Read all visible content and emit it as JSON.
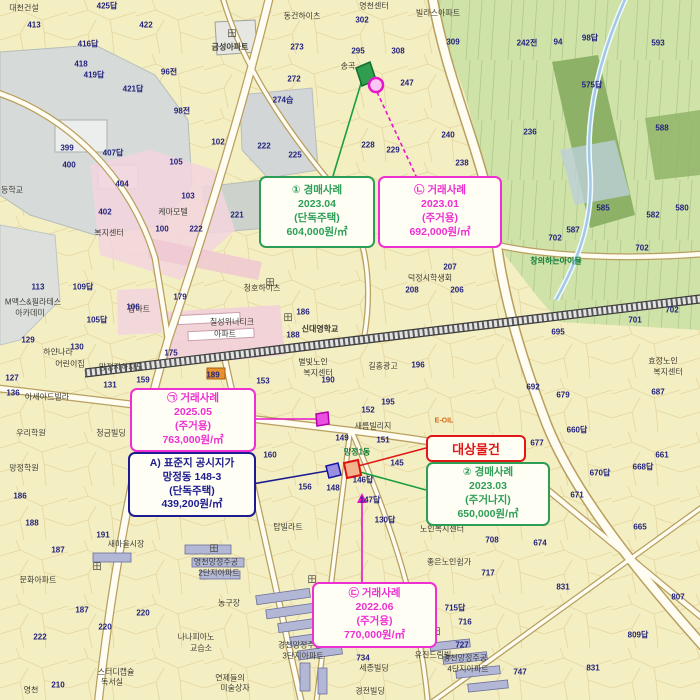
{
  "subject": {
    "label": "대상물건"
  },
  "callouts": [
    {
      "id": "auction-1",
      "kind": "경매사례",
      "lines": [
        "① 경매사례",
        "2023.04",
        "(단독주택)",
        "604,000원/㎡"
      ],
      "color": "#2e9e57"
    },
    {
      "id": "sale-nieun",
      "kind": "거래사례",
      "lines": [
        "㉡ 거래사례",
        "2023.01",
        "(주거용)",
        "692,000원/㎡"
      ],
      "color": "#ee2fd2"
    },
    {
      "id": "sale-giyeok",
      "kind": "거래사례",
      "lines": [
        "㉠ 거래사례",
        "2025.05",
        "(주거용)",
        "763,000원/㎡"
      ],
      "color": "#ee2fd2"
    },
    {
      "id": "standard-lot",
      "kind": "표준지 공시지가",
      "lines": [
        "A) 표준지 공시지가",
        "망정동 148-3",
        "(단독주택)",
        "439,200원/㎡"
      ],
      "color": "#1c1c90"
    },
    {
      "id": "auction-2",
      "kind": "경매사례",
      "lines": [
        "② 경매사례",
        "2023.03",
        "(주거나지)",
        "650,000원/㎡"
      ],
      "color": "#2e9e57"
    },
    {
      "id": "sale-digeut",
      "kind": "거래사례",
      "lines": [
        "㉢ 거래사례",
        "2022.06",
        "(주거용)",
        "770,000원/㎡"
      ],
      "color": "#ee2fd2"
    }
  ],
  "colors": {
    "map_bg": "#f4eec3",
    "forest": "#cfe2a8",
    "forest_dark": "#85ad5f",
    "water_gray": "#d6dbd9",
    "pink_zone": "#f3d5de",
    "road": "#fffdf2",
    "parcel_number": "#23237c",
    "green_case": "#2e9e57",
    "magenta_case": "#ee2fd2",
    "navy_standard": "#1c1c90",
    "red_subject": "#e01818"
  },
  "map": {
    "place_labels": [
      {
        "t": "대천건설",
        "x": 24,
        "y": 8
      },
      {
        "t": "영천센터",
        "x": 374,
        "y": 6
      },
      {
        "t": "빌라스아파트",
        "x": 438,
        "y": 13
      },
      {
        "t": "동건하이츠",
        "x": 302,
        "y": 16
      },
      {
        "t": "금성아파트",
        "x": 230,
        "y": 47,
        "c": "bold"
      },
      {
        "t": "송곡",
        "x": 348,
        "y": 66
      },
      {
        "t": "케마모텔",
        "x": 173,
        "y": 212
      },
      {
        "t": "복지센터",
        "x": 109,
        "y": 233
      },
      {
        "t": "청호하이츠",
        "x": 262,
        "y": 288
      },
      {
        "t": "탑마트",
        "x": 139,
        "y": 309
      },
      {
        "t": "칠성위너티크",
        "x": 232,
        "y": 322
      },
      {
        "t": "아파트",
        "x": 225,
        "y": 334
      },
      {
        "t": "신대영학교",
        "x": 320,
        "y": 329,
        "c": "bold"
      },
      {
        "t": "별빛노인",
        "x": 313,
        "y": 362
      },
      {
        "t": "복지센터",
        "x": 318,
        "y": 373
      },
      {
        "t": "길홍광고",
        "x": 383,
        "y": 366
      },
      {
        "t": "덕정시학생회",
        "x": 430,
        "y": 278
      },
      {
        "t": "창의하는아이들",
        "x": 556,
        "y": 261,
        "c": "green"
      },
      {
        "t": "효정노인",
        "x": 663,
        "y": 361
      },
      {
        "t": "복지센터",
        "x": 668,
        "y": 372
      },
      {
        "t": "망정지하차도",
        "x": 121,
        "y": 367
      },
      {
        "t": "하얀나라",
        "x": 58,
        "y": 352
      },
      {
        "t": "어린이집",
        "x": 70,
        "y": 364
      },
      {
        "t": "아세아드빌라",
        "x": 47,
        "y": 397
      },
      {
        "t": "우리학원",
        "x": 31,
        "y": 433
      },
      {
        "t": "청금빌딩",
        "x": 111,
        "y": 433
      },
      {
        "t": "망정학원",
        "x": 24,
        "y": 468
      },
      {
        "t": "새름빌리지",
        "x": 373,
        "y": 426
      },
      {
        "t": "망정1동",
        "x": 357,
        "y": 452,
        "c": "green"
      },
      {
        "t": "탑빌라트",
        "x": 288,
        "y": 527
      },
      {
        "t": "새마을시장",
        "x": 126,
        "y": 544
      },
      {
        "t": "문화아파트",
        "x": 38,
        "y": 580
      },
      {
        "t": "M맥스&필라테스",
        "x": 33,
        "y": 302
      },
      {
        "t": "아카데미",
        "x": 30,
        "y": 313
      },
      {
        "t": "농구장",
        "x": 229,
        "y": 603
      },
      {
        "t": "나나피아노",
        "x": 196,
        "y": 637
      },
      {
        "t": "교습소",
        "x": 201,
        "y": 648
      },
      {
        "t": "스터디캡슐",
        "x": 116,
        "y": 672
      },
      {
        "t": "독서실",
        "x": 112,
        "y": 682
      },
      {
        "t": "연제들의",
        "x": 230,
        "y": 678
      },
      {
        "t": "미술상자",
        "x": 235,
        "y": 688
      },
      {
        "t": "영천",
        "x": 31,
        "y": 690
      },
      {
        "t": "영천망정주공",
        "x": 216,
        "y": 562
      },
      {
        "t": "2단지아파트",
        "x": 219,
        "y": 573
      },
      {
        "t": "경천망정주공",
        "x": 300,
        "y": 645
      },
      {
        "t": "3단지아파트",
        "x": 303,
        "y": 656
      },
      {
        "t": "경천망정주공",
        "x": 465,
        "y": 658
      },
      {
        "t": "4단지아파트",
        "x": 468,
        "y": 669
      },
      {
        "t": "세종빌딩",
        "x": 374,
        "y": 668
      },
      {
        "t": "경전빌딩",
        "x": 370,
        "y": 691
      },
      {
        "t": "유진드림빌",
        "x": 433,
        "y": 655
      },
      {
        "t": "노인복지센터",
        "x": 442,
        "y": 529
      },
      {
        "t": "좋은노인쉼가",
        "x": 449,
        "y": 562
      },
      {
        "t": "E-OIL",
        "x": 444,
        "y": 421,
        "c": "orange"
      },
      {
        "t": "등학교",
        "x": 12,
        "y": 190
      },
      {
        "t": "田",
        "x": 232,
        "y": 33,
        "c": "sym"
      },
      {
        "t": "田",
        "x": 270,
        "y": 282,
        "c": "sym"
      },
      {
        "t": "田",
        "x": 97,
        "y": 566,
        "c": "sym"
      },
      {
        "t": "田",
        "x": 214,
        "y": 548,
        "c": "sym"
      },
      {
        "t": "田",
        "x": 312,
        "y": 579,
        "c": "sym"
      },
      {
        "t": "田",
        "x": 436,
        "y": 631,
        "c": "sym"
      },
      {
        "t": "田",
        "x": 288,
        "y": 317,
        "c": "sym"
      }
    ],
    "parcel_numbers": [
      {
        "t": "425답",
        "x": 107,
        "y": 6
      },
      {
        "t": "422",
        "x": 146,
        "y": 25
      },
      {
        "t": "413",
        "x": 34,
        "y": 25
      },
      {
        "t": "418",
        "x": 81,
        "y": 64
      },
      {
        "t": "416답",
        "x": 88,
        "y": 44
      },
      {
        "t": "419답",
        "x": 94,
        "y": 75
      },
      {
        "t": "421답",
        "x": 133,
        "y": 89
      },
      {
        "t": "96전",
        "x": 169,
        "y": 72
      },
      {
        "t": "98전",
        "x": 182,
        "y": 111
      },
      {
        "t": "302",
        "x": 362,
        "y": 20
      },
      {
        "t": "309",
        "x": 453,
        "y": 42
      },
      {
        "t": "295",
        "x": 358,
        "y": 51
      },
      {
        "t": "308",
        "x": 398,
        "y": 51
      },
      {
        "t": "273",
        "x": 297,
        "y": 47
      },
      {
        "t": "272",
        "x": 294,
        "y": 79
      },
      {
        "t": "274습",
        "x": 283,
        "y": 100
      },
      {
        "t": "247",
        "x": 407,
        "y": 83
      },
      {
        "t": "240",
        "x": 448,
        "y": 135
      },
      {
        "t": "238",
        "x": 462,
        "y": 163
      },
      {
        "t": "229",
        "x": 393,
        "y": 150
      },
      {
        "t": "228",
        "x": 368,
        "y": 145
      },
      {
        "t": "225",
        "x": 295,
        "y": 155
      },
      {
        "t": "222",
        "x": 264,
        "y": 146
      },
      {
        "t": "221",
        "x": 237,
        "y": 215
      },
      {
        "t": "242전",
        "x": 527,
        "y": 43
      },
      {
        "t": "94",
        "x": 558,
        "y": 42
      },
      {
        "t": "98답",
        "x": 590,
        "y": 38
      },
      {
        "t": "593",
        "x": 658,
        "y": 43
      },
      {
        "t": "575답",
        "x": 592,
        "y": 85
      },
      {
        "t": "236",
        "x": 530,
        "y": 132
      },
      {
        "t": "588",
        "x": 662,
        "y": 128
      },
      {
        "t": "585",
        "x": 603,
        "y": 208
      },
      {
        "t": "582",
        "x": 653,
        "y": 215
      },
      {
        "t": "580",
        "x": 682,
        "y": 208
      },
      {
        "t": "587",
        "x": 573,
        "y": 230
      },
      {
        "t": "702",
        "x": 555,
        "y": 238
      },
      {
        "t": "702",
        "x": 642,
        "y": 248
      },
      {
        "t": "701",
        "x": 635,
        "y": 320
      },
      {
        "t": "702",
        "x": 672,
        "y": 310
      },
      {
        "t": "695",
        "x": 558,
        "y": 332
      },
      {
        "t": "399",
        "x": 67,
        "y": 148
      },
      {
        "t": "400",
        "x": 69,
        "y": 165
      },
      {
        "t": "402",
        "x": 105,
        "y": 212
      },
      {
        "t": "404",
        "x": 122,
        "y": 184
      },
      {
        "t": "407답",
        "x": 113,
        "y": 153
      },
      {
        "t": "105",
        "x": 176,
        "y": 162
      },
      {
        "t": "102",
        "x": 218,
        "y": 142
      },
      {
        "t": "103",
        "x": 188,
        "y": 196
      },
      {
        "t": "100",
        "x": 162,
        "y": 229
      },
      {
        "t": "222",
        "x": 196,
        "y": 229
      },
      {
        "t": "179",
        "x": 180,
        "y": 297
      },
      {
        "t": "106",
        "x": 133,
        "y": 307
      },
      {
        "t": "109답",
        "x": 83,
        "y": 287
      },
      {
        "t": "105답",
        "x": 97,
        "y": 320
      },
      {
        "t": "113",
        "x": 38,
        "y": 287
      },
      {
        "t": "127",
        "x": 12,
        "y": 378
      },
      {
        "t": "129",
        "x": 28,
        "y": 340
      },
      {
        "t": "130",
        "x": 77,
        "y": 347
      },
      {
        "t": "131",
        "x": 110,
        "y": 385
      },
      {
        "t": "159",
        "x": 143,
        "y": 380
      },
      {
        "t": "136",
        "x": 13,
        "y": 393
      },
      {
        "t": "186",
        "x": 20,
        "y": 496
      },
      {
        "t": "187",
        "x": 58,
        "y": 550
      },
      {
        "t": "187",
        "x": 82,
        "y": 610
      },
      {
        "t": "188",
        "x": 32,
        "y": 523
      },
      {
        "t": "186",
        "x": 303,
        "y": 312
      },
      {
        "t": "188",
        "x": 293,
        "y": 335
      },
      {
        "t": "175",
        "x": 171,
        "y": 353
      },
      {
        "t": "191",
        "x": 103,
        "y": 535
      },
      {
        "t": "220",
        "x": 143,
        "y": 613
      },
      {
        "t": "220",
        "x": 105,
        "y": 627
      },
      {
        "t": "222",
        "x": 40,
        "y": 637
      },
      {
        "t": "210",
        "x": 58,
        "y": 685
      },
      {
        "t": "196",
        "x": 418,
        "y": 365
      },
      {
        "t": "195",
        "x": 388,
        "y": 402
      },
      {
        "t": "152",
        "x": 368,
        "y": 410
      },
      {
        "t": "151",
        "x": 383,
        "y": 440
      },
      {
        "t": "149",
        "x": 342,
        "y": 438
      },
      {
        "t": "145",
        "x": 397,
        "y": 463
      },
      {
        "t": "146답",
        "x": 363,
        "y": 480
      },
      {
        "t": "148",
        "x": 333,
        "y": 488
      },
      {
        "t": "147답",
        "x": 370,
        "y": 500
      },
      {
        "t": "156",
        "x": 305,
        "y": 487
      },
      {
        "t": "160",
        "x": 270,
        "y": 455
      },
      {
        "t": "130답",
        "x": 385,
        "y": 520
      },
      {
        "t": "671",
        "x": 577,
        "y": 495
      },
      {
        "t": "674",
        "x": 540,
        "y": 543
      },
      {
        "t": "708",
        "x": 492,
        "y": 540
      },
      {
        "t": "717",
        "x": 488,
        "y": 573
      },
      {
        "t": "665",
        "x": 640,
        "y": 527
      },
      {
        "t": "661",
        "x": 662,
        "y": 455
      },
      {
        "t": "668답",
        "x": 643,
        "y": 467
      },
      {
        "t": "670답",
        "x": 600,
        "y": 473
      },
      {
        "t": "679",
        "x": 563,
        "y": 395
      },
      {
        "t": "692",
        "x": 533,
        "y": 387
      },
      {
        "t": "687",
        "x": 658,
        "y": 392
      },
      {
        "t": "660답",
        "x": 577,
        "y": 430
      },
      {
        "t": "677",
        "x": 537,
        "y": 443
      },
      {
        "t": "831",
        "x": 563,
        "y": 587
      },
      {
        "t": "831",
        "x": 593,
        "y": 668
      },
      {
        "t": "807",
        "x": 678,
        "y": 597
      },
      {
        "t": "809답",
        "x": 638,
        "y": 635
      },
      {
        "t": "715답",
        "x": 455,
        "y": 608
      },
      {
        "t": "716",
        "x": 465,
        "y": 622
      },
      {
        "t": "727",
        "x": 462,
        "y": 645
      },
      {
        "t": "747",
        "x": 520,
        "y": 672
      },
      {
        "t": "734",
        "x": 363,
        "y": 658
      },
      {
        "t": "206",
        "x": 457,
        "y": 290
      },
      {
        "t": "207",
        "x": 450,
        "y": 267
      },
      {
        "t": "208",
        "x": 412,
        "y": 290
      },
      {
        "t": "153",
        "x": 263,
        "y": 381
      },
      {
        "t": "189",
        "x": 213,
        "y": 375
      },
      {
        "t": "190",
        "x": 328,
        "y": 380
      }
    ]
  }
}
